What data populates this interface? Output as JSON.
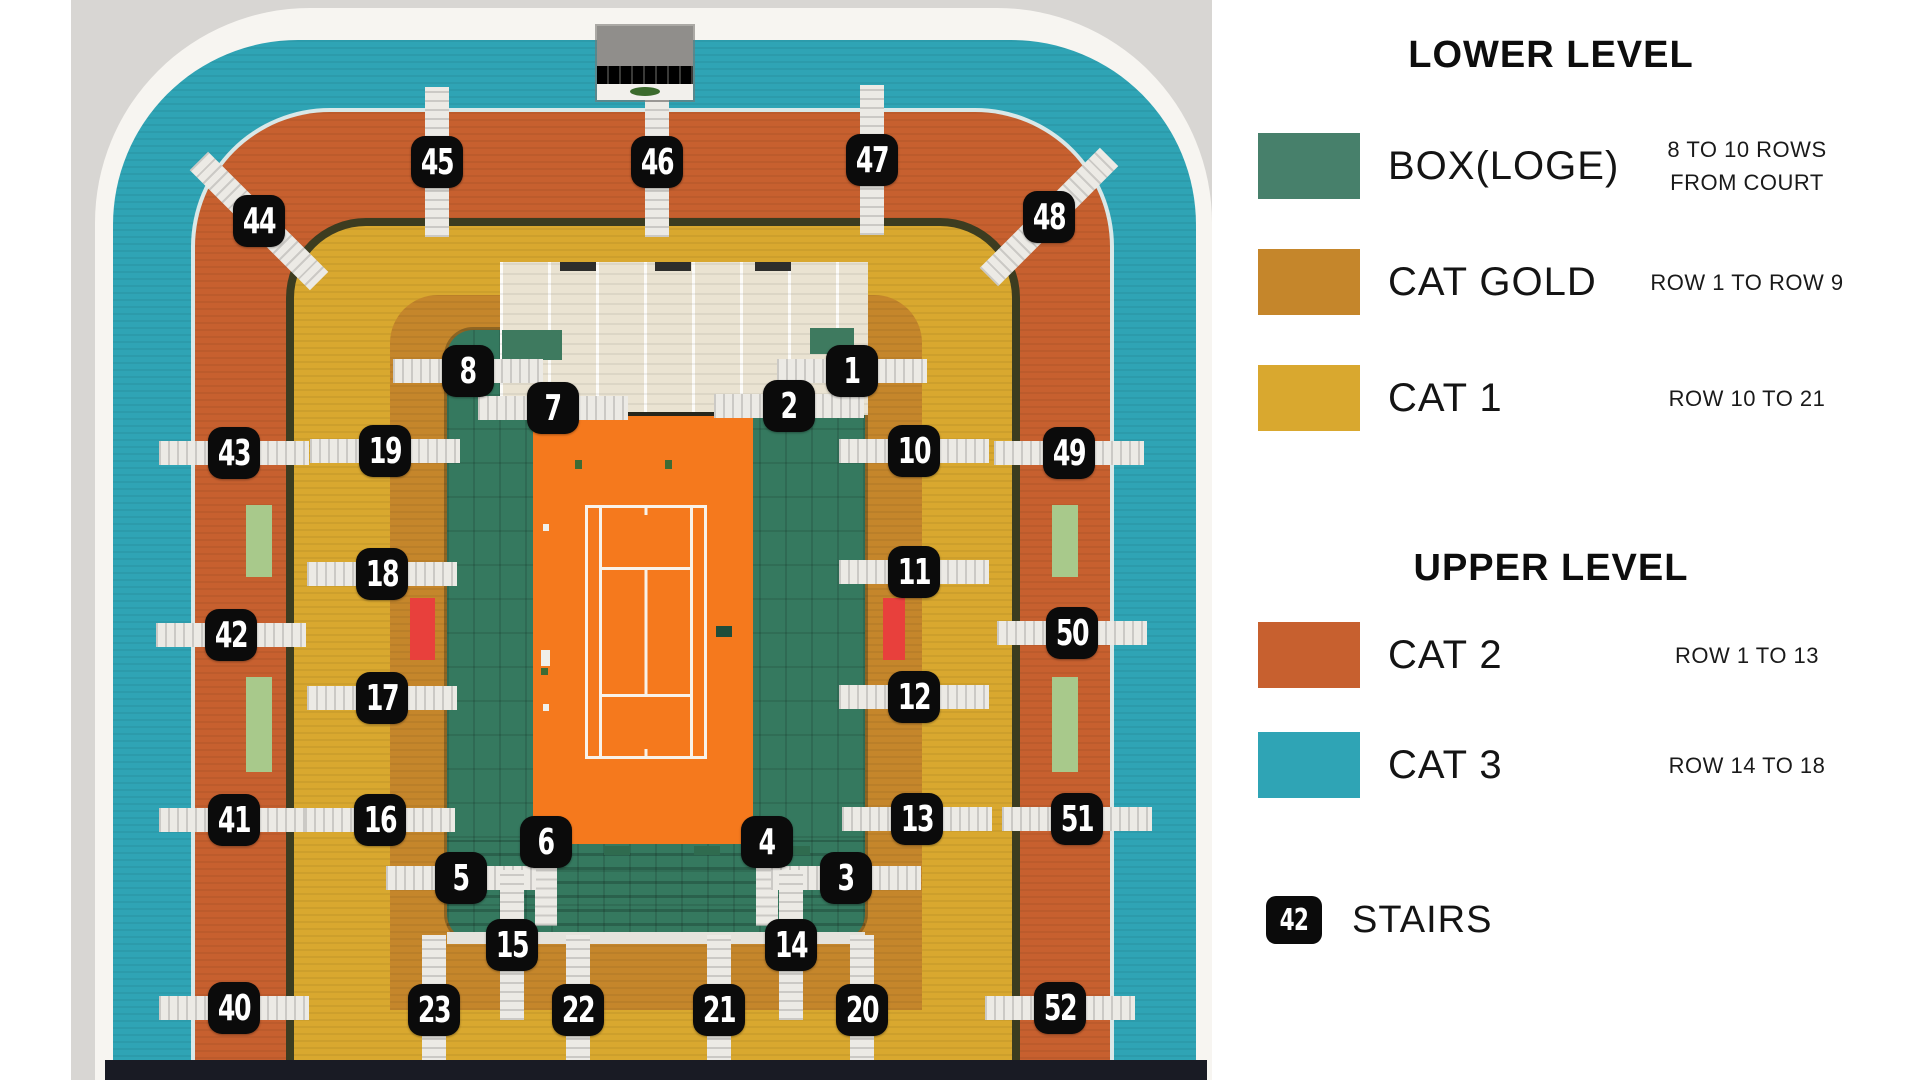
{
  "legend": {
    "sections": [
      {
        "title": "LOWER LEVEL",
        "items": [
          {
            "id": "box-loge",
            "label": "BOX(LOGE)",
            "color": "#47806B",
            "notes": [
              "8 TO 10 ROWS",
              "FROM COURT"
            ]
          },
          {
            "id": "cat-gold",
            "label": "CAT GOLD",
            "color": "#C5862B",
            "notes": [
              "ROW 1 TO ROW 9"
            ]
          },
          {
            "id": "cat-1",
            "label": "CAT 1",
            "color": "#D9A82F",
            "notes": [
              "ROW 10 TO 21"
            ]
          }
        ]
      },
      {
        "title": "UPPER LEVEL",
        "items": [
          {
            "id": "cat-2",
            "label": "CAT 2",
            "color": "#C7602F",
            "notes": [
              "ROW 1 TO 13"
            ]
          },
          {
            "id": "cat-3",
            "label": "CAT 3",
            "color": "#2FA4B5",
            "notes": [
              "ROW 14 TO 18"
            ]
          }
        ]
      }
    ],
    "stairs": {
      "badge_number": "42",
      "label": "STAIRS",
      "badge_color": "#0B0B0B"
    }
  },
  "map": {
    "colors": {
      "cat3": "#2FA4B5",
      "cat2": "#C7602F",
      "cat1": "#D9A82F",
      "cat_gold": "#C5862B",
      "box_green": "#35795F",
      "court_clay": "#F5791D",
      "red_block": "#E8403C",
      "tribune_cream": "#EAE3D2",
      "shell_white": "#F7F5F1",
      "badge": "#0B0B0B"
    },
    "badges": [
      {
        "n": "45",
        "x": 437,
        "y": 162,
        "dir": "v"
      },
      {
        "n": "46",
        "x": 657,
        "y": 162,
        "dir": "v"
      },
      {
        "n": "47",
        "x": 872,
        "y": 160,
        "dir": "v"
      },
      {
        "n": "44",
        "x": 259,
        "y": 221,
        "dir": "d1"
      },
      {
        "n": "48",
        "x": 1049,
        "y": 217,
        "dir": "d2"
      },
      {
        "n": "8",
        "x": 468,
        "y": 371,
        "dir": "h"
      },
      {
        "n": "1",
        "x": 852,
        "y": 371,
        "dir": "h"
      },
      {
        "n": "7",
        "x": 553,
        "y": 408,
        "dir": "h"
      },
      {
        "n": "2",
        "x": 789,
        "y": 406,
        "dir": "h"
      },
      {
        "n": "43",
        "x": 234,
        "y": 453,
        "dir": "h"
      },
      {
        "n": "19",
        "x": 385,
        "y": 451,
        "dir": "h"
      },
      {
        "n": "10",
        "x": 914,
        "y": 451,
        "dir": "h"
      },
      {
        "n": "49",
        "x": 1069,
        "y": 453,
        "dir": "h"
      },
      {
        "n": "18",
        "x": 382,
        "y": 574,
        "dir": "h"
      },
      {
        "n": "11",
        "x": 914,
        "y": 572,
        "dir": "h"
      },
      {
        "n": "42",
        "x": 231,
        "y": 635,
        "dir": "h"
      },
      {
        "n": "50",
        "x": 1072,
        "y": 633,
        "dir": "h"
      },
      {
        "n": "17",
        "x": 382,
        "y": 698,
        "dir": "h"
      },
      {
        "n": "12",
        "x": 914,
        "y": 697,
        "dir": "h"
      },
      {
        "n": "41",
        "x": 234,
        "y": 820,
        "dir": "h"
      },
      {
        "n": "16",
        "x": 380,
        "y": 820,
        "dir": "h"
      },
      {
        "n": "13",
        "x": 917,
        "y": 819,
        "dir": "h"
      },
      {
        "n": "51",
        "x": 1077,
        "y": 819,
        "dir": "h"
      },
      {
        "n": "6",
        "x": 546,
        "y": 842,
        "dir": "v2"
      },
      {
        "n": "4",
        "x": 767,
        "y": 842,
        "dir": "v2"
      },
      {
        "n": "5",
        "x": 461,
        "y": 878,
        "dir": "h"
      },
      {
        "n": "3",
        "x": 846,
        "y": 878,
        "dir": "h"
      },
      {
        "n": "15",
        "x": 512,
        "y": 945,
        "dir": "v"
      },
      {
        "n": "14",
        "x": 791,
        "y": 945,
        "dir": "v"
      },
      {
        "n": "40",
        "x": 234,
        "y": 1008,
        "dir": "h"
      },
      {
        "n": "23",
        "x": 434,
        "y": 1010,
        "dir": "v"
      },
      {
        "n": "22",
        "x": 578,
        "y": 1010,
        "dir": "v"
      },
      {
        "n": "21",
        "x": 719,
        "y": 1010,
        "dir": "v"
      },
      {
        "n": "20",
        "x": 862,
        "y": 1010,
        "dir": "v"
      },
      {
        "n": "52",
        "x": 1060,
        "y": 1008,
        "dir": "h"
      }
    ]
  }
}
